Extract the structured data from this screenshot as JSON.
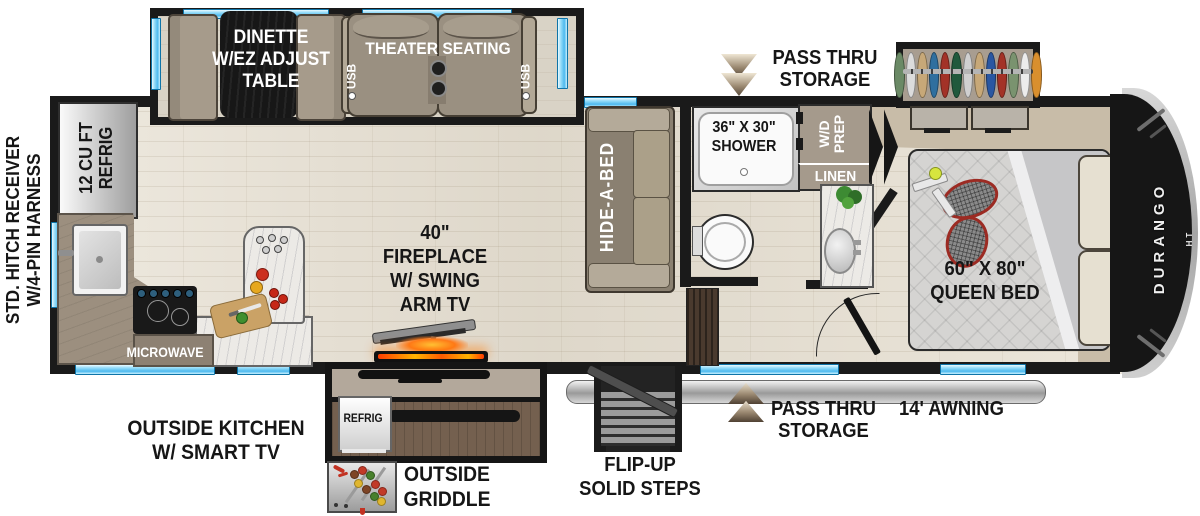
{
  "brand": {
    "logo": "DURANGO",
    "logo_sub": "HT"
  },
  "labels": {
    "hitch": "STD. HITCH RECEIVER\nW/4-PIN HARNESS",
    "refrig_12": "12 CU FT\nREFRIG",
    "dinette": "DINETTE\nW/EZ ADJUST\nTABLE",
    "theater": "THEATER SEATING",
    "usb": "USB",
    "hide_a_bed": "HIDE-A-BED",
    "pass_thru": "PASS THRU\nSTORAGE",
    "shower": "36\" X 30\"\nSHOWER",
    "wd_prep": "W/D\nPREP",
    "linen": "LINEN",
    "queen_bed": "60\" X 80\"\nQUEEN BED",
    "fireplace": "40\"\nFIREPLACE\nW/ SWING\nARM TV",
    "microwave": "MICROWAVE",
    "outside_kitchen": "OUTSIDE KITCHEN\nW/ SMART TV",
    "refrig_outside": "REFRIG",
    "outside_griddle": "OUTSIDE\nGRIDDLE",
    "flip_up_steps": "FLIP-UP\nSOLID STEPS",
    "awning": "14' AWNING"
  },
  "colors": {
    "wall": "#1a1a1a",
    "window_blue": "#4db9ee",
    "floor_wood": "#e7e0d2",
    "platform_tan": "#c8bca8",
    "furniture_taupe": "#9a9081",
    "fire_glow": "#ff7a1a",
    "awning_gray": "#9a9a9a",
    "arrow_tan": "#9c8a72"
  },
  "closet_clothes_colors": [
    "#6b8a66",
    "#dcdcdc",
    "#c7a878",
    "#2f6f9f",
    "#a33227",
    "#20593c",
    "#d0d0d0",
    "#c7a878",
    "#2a57a2",
    "#a33227",
    "#7a936f",
    "#ececec",
    "#d98f2e"
  ]
}
